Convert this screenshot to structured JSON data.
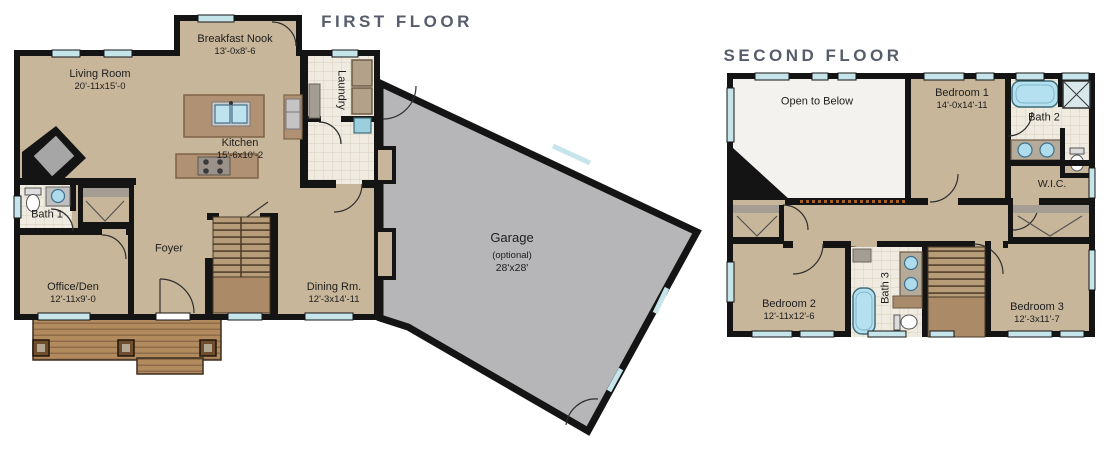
{
  "first_floor": {
    "title": "FIRST FLOOR",
    "rooms": {
      "breakfast_nook": {
        "name": "Breakfast Nook",
        "dims": "13'-0x8'-6"
      },
      "living_room": {
        "name": "Living Room",
        "dims": "20'-11x15'-0"
      },
      "laundry": {
        "name": "Laundry"
      },
      "kitchen": {
        "name": "Kitchen",
        "dims": "15'-6x10'-2"
      },
      "bath_1": {
        "name": "Bath 1"
      },
      "foyer": {
        "name": "Foyer"
      },
      "office_den": {
        "name": "Office/Den",
        "dims": "12'-11x9'-0"
      },
      "dining_room": {
        "name": "Dining Rm.",
        "dims": "12'-3x14'-11"
      },
      "garage": {
        "name": "Garage",
        "note": "(optional)",
        "dims": "28'x28'"
      }
    }
  },
  "second_floor": {
    "title": "SECOND FLOOR",
    "rooms": {
      "open_to_below": {
        "name": "Open to Below"
      },
      "bedroom_1": {
        "name": "Bedroom 1",
        "dims": "14'-0x14'-11"
      },
      "bath_2": {
        "name": "Bath 2"
      },
      "wic": {
        "name": "W.I.C."
      },
      "bedroom_2": {
        "name": "Bedroom 2",
        "dims": "12'-11x12'-6"
      },
      "bath_3": {
        "name": "Bath 3"
      },
      "bedroom_3": {
        "name": "Bedroom 3",
        "dims": "12'-3x11'-7"
      }
    }
  },
  "colors": {
    "wall": "#141414",
    "room_tan": "#c8b69a",
    "tile": "#f0ebe0",
    "window_blue": "#c6e5eb",
    "garage_gray": "#b6b6b8",
    "fixture_blue": "#b5e0ef",
    "wood_brown": "#b18a5e",
    "stair_tread": "#b79c79",
    "title_text": "#575d6b",
    "label_text": "#1d1d1d"
  }
}
